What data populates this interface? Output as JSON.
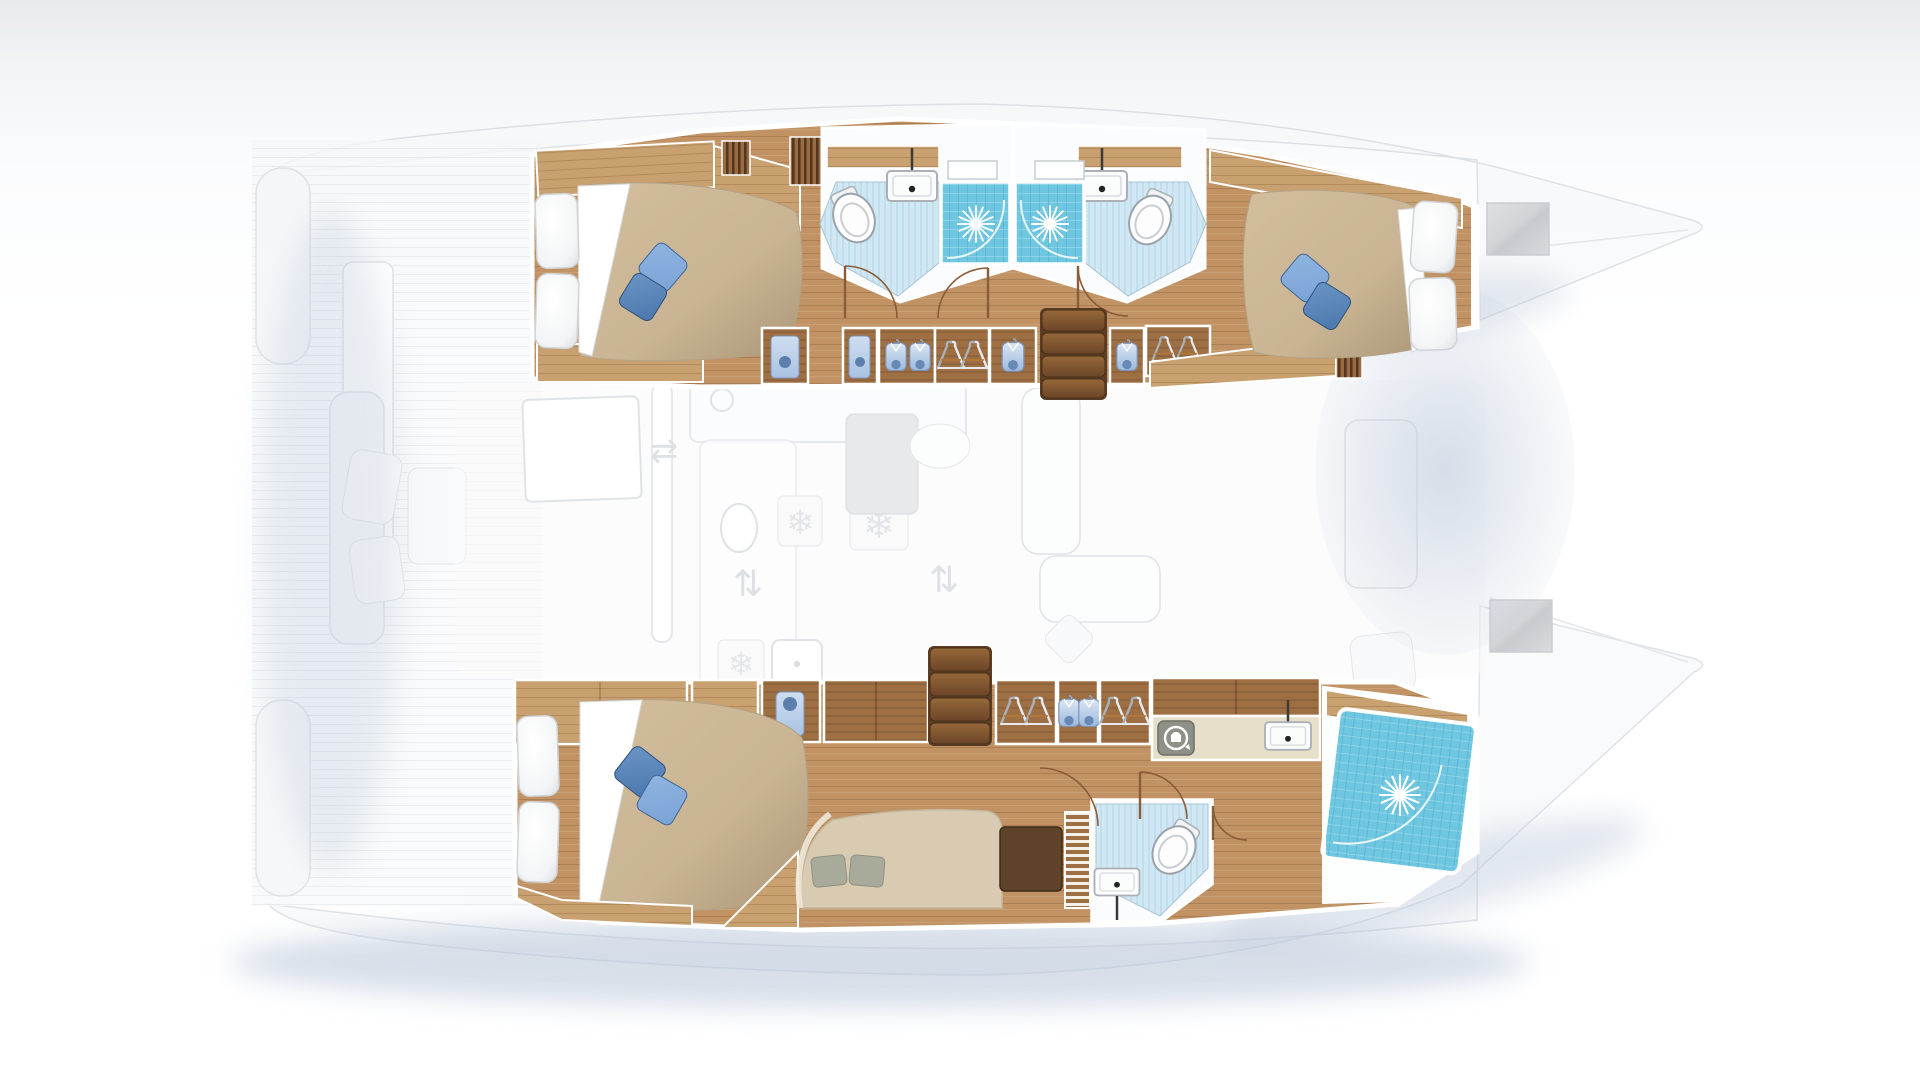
{
  "meta": {
    "title": "Catamaran interior layout — top-down deck plan",
    "diagram_type": "floor-plan",
    "orientation": "bow-right",
    "highlighted_deck": "hull accommodation deck",
    "faded_deck": "main deck: salon, galley, cockpit, foredeck"
  },
  "colors": {
    "wood_floor": "#c19364",
    "wood_floor_dark": "#ab7f52",
    "wood_cabinet_light": "#c9a171",
    "wood_cabinet": "#9d6f43",
    "wood_dark": "#6b4527",
    "stairs_light": "#96683a",
    "stairs_dark": "#6b4527",
    "duvet": "#c9b493",
    "duvet_shadow": "#ab9778",
    "pillow_white": "#ffffff",
    "pillow_blue_light": "#7aa3d6",
    "pillow_blue_dark": "#4a77ad",
    "bath_floor": "#cfe8f4",
    "shower_aqua": "#6ec6e0",
    "shower_aqua_dark": "#4fb0cf",
    "fixture_white": "#fdfdfd",
    "fixture_outline": "#9aa2ab",
    "ghost_fill": "#f5f6f8",
    "ghost_line": "#c9ced6",
    "shadow_blue": "#b7c5d8",
    "hull_wall_white": "#ffffff",
    "sofa_beige": "#d8cbb2",
    "cushion_sage": "#a9ab9a",
    "desk_brown": "#5e4229",
    "counter_beige": "#e6dfca",
    "appliance_grey": "#8f9087",
    "glass_blue": "#a9c2e2"
  },
  "icons": {
    "snowflake": "❄",
    "arrows_horizontal": "⇄",
    "arrows_vertical": "⇅"
  },
  "hulls": {
    "top": {
      "name": "Port hull",
      "rooms": [
        {
          "name": "Aft double cabin",
          "furniture": [
            "double bed",
            "white pillows",
            "blue accent cushions",
            "overhead lockers",
            "louvered vent"
          ]
        },
        {
          "name": "Aft bathroom",
          "furniture": [
            "toilet",
            "washbasin",
            "shower cabin with glass door"
          ]
        },
        {
          "name": "Forward bathroom",
          "furniture": [
            "shower cabin with glass door",
            "washbasin",
            "toilet"
          ]
        },
        {
          "name": "Forward double cabin",
          "furniture": [
            "double bed",
            "white pillows",
            "blue accent cushions"
          ]
        },
        {
          "name": "Companionway",
          "furniture": [
            "4-step staircase",
            "hanging lockers",
            "shirt lockers",
            "wet lockers"
          ]
        }
      ]
    },
    "bottom": {
      "name": "Starboard hull — owner suite",
      "rooms": [
        {
          "name": "Owner double cabin",
          "furniture": [
            "double bed",
            "white pillows",
            "blue accent cushions",
            "sofa with cushions",
            "vanity desk"
          ]
        },
        {
          "name": "Day head",
          "furniture": [
            "toilet",
            "washbasin"
          ]
        },
        {
          "name": "Dressing area",
          "furniture": [
            "hanging lockers",
            "shirt lockers"
          ]
        },
        {
          "name": "Utility bathroom",
          "furniture": [
            "washing machine",
            "washbasin",
            "large shower cabin"
          ]
        },
        {
          "name": "Companionway",
          "furniture": [
            "4-step staircase"
          ]
        }
      ]
    },
    "center": {
      "name": "Main deck (faded)",
      "rooms": [
        {
          "name": "Salon and galley",
          "furniture": [
            "galley counters",
            "sink",
            "refrigerators",
            "dining table",
            "sofas"
          ]
        },
        {
          "name": "Aft cockpit",
          "furniture": [
            "bench",
            "cushions"
          ]
        },
        {
          "name": "Foredeck",
          "furniture": [
            "deck hatches"
          ]
        }
      ]
    }
  }
}
